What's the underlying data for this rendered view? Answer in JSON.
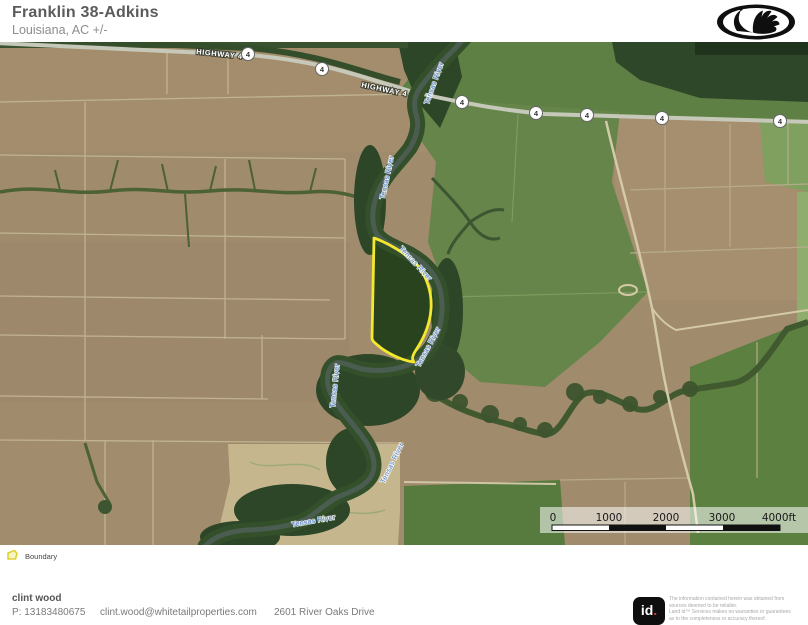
{
  "header": {
    "title": "Franklin 38-Adkins",
    "subtitle": "Louisiana,  AC +/-"
  },
  "map": {
    "highway_label": "HIGHWAY 4",
    "route_badge": "4",
    "river_label": "Tensas River",
    "boundary_color": "#f2e82e",
    "scale": {
      "ticks": [
        "0",
        "1000",
        "2000",
        "3000",
        "4000ft"
      ]
    }
  },
  "legend": {
    "boundary_label": "Boundary"
  },
  "footer": {
    "agent_name": "clint wood",
    "phone": "P: 13183480675",
    "email": "clint.wood@whitetailproperties.com",
    "address": "2601 River Oaks Drive",
    "brand": {
      "logo_text": "id",
      "logo_dot": "."
    },
    "disclaimer_lines": [
      "The information contained herein was obtained from",
      "sources deemed to be reliable.",
      " Land id™ Services makes no warranties or guarantees",
      "as to the completeness or accuracy thereof."
    ]
  }
}
